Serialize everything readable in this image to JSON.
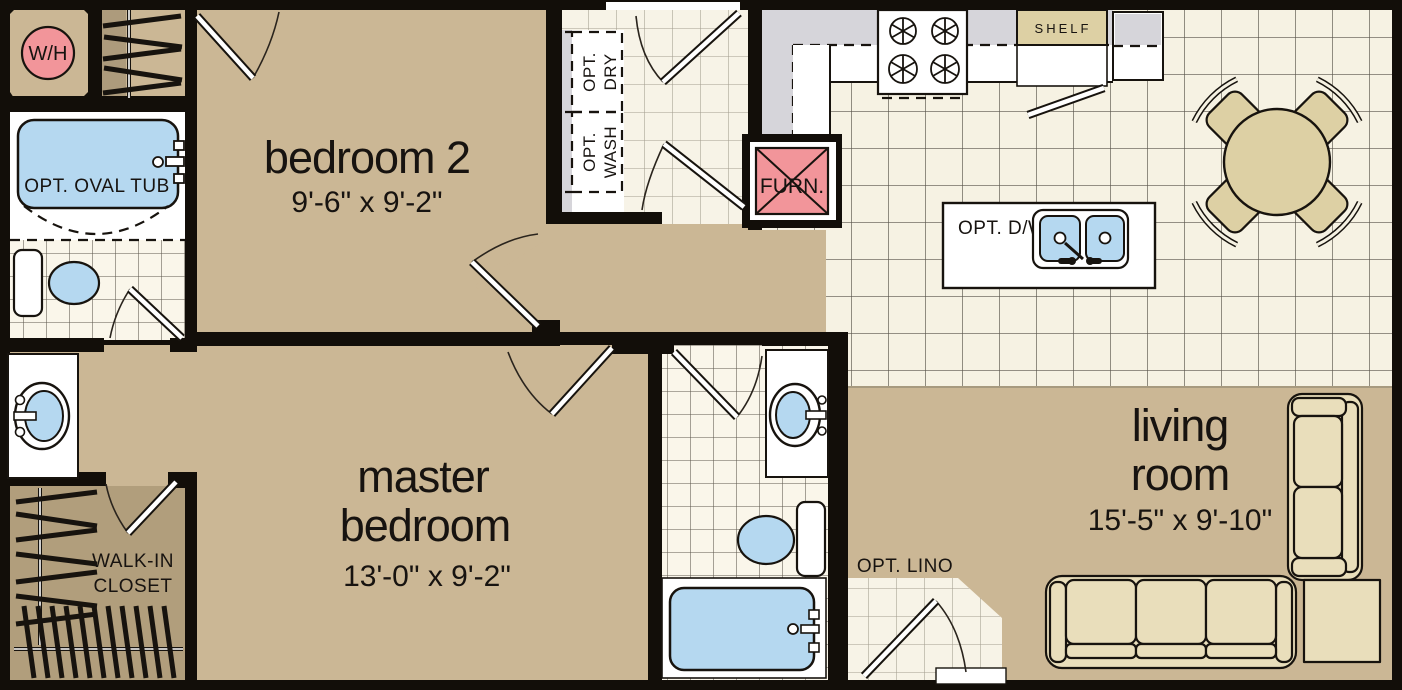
{
  "floorplan": {
    "rooms": {
      "bedroom2": {
        "name": "bedroom 2",
        "dims": "9'-6\" x 9'-2\""
      },
      "master_bedroom": {
        "name_l1": "master",
        "name_l2": "bedroom",
        "dims": "13'-0\" x 9'-2\""
      },
      "living_room": {
        "name_l1": "living",
        "name_l2": "room",
        "dims": "15'-5\" x 9'-10\""
      },
      "walk_in_closet": {
        "name_l1": "WALK-IN",
        "name_l2": "CLOSET"
      }
    },
    "labels": {
      "water_heater": "W/H",
      "furnace": "FURN.",
      "oval_tub": "OPT. OVAL TUB",
      "dryer_l1": "OPT.",
      "dryer_l2": "DRY",
      "washer_l1": "OPT.",
      "washer_l2": "WASH",
      "shelf": "SHELF",
      "dishwasher": "OPT. D/W",
      "lino": "OPT. LINO"
    },
    "colors": {
      "wall": "#120e09",
      "room_tan": "#cbb795",
      "closet_tan": "#b19e7c",
      "tile_cream": "#f6f2e3",
      "fixture_blue": "#b5d8f0",
      "alert_pink": "#f2959a",
      "counter_gray": "#d6d5da",
      "furniture_cream": "#e9debb",
      "wood_tan": "#ddd0a4",
      "white": "#ffffff"
    }
  }
}
